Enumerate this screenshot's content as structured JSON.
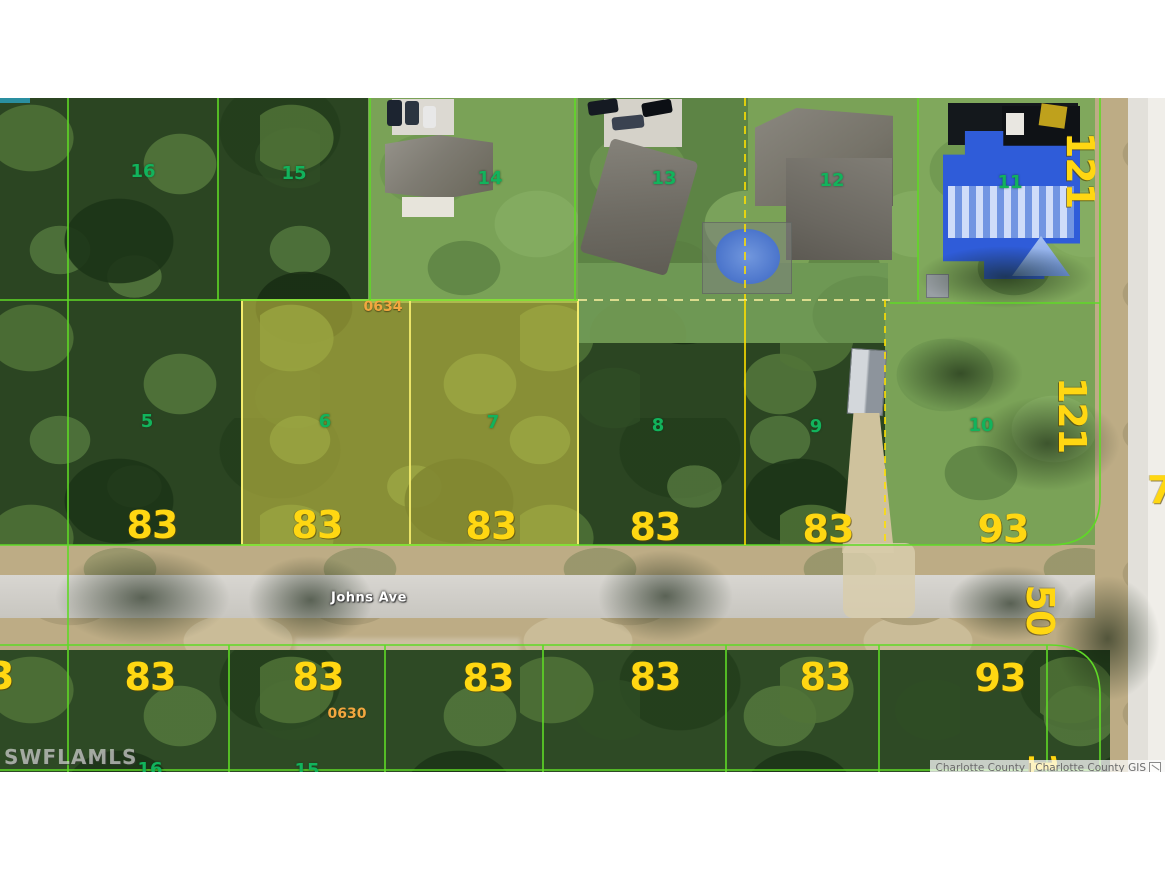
{
  "page": {
    "background": "#ffffff"
  },
  "map": {
    "street": {
      "label": "Johns Ave",
      "x": 369,
      "y": 598
    },
    "watermark": "SWFLAMLS",
    "attribution": "Charlotte County | Charlotte County GIS",
    "colors": {
      "boundary_green": "#5fd926",
      "boundary_yellow": "#ffe000",
      "highlight_fill": "rgba(213,204,71,0.55)",
      "parcel_number_green": "#12b35c",
      "dimension_yellow": "#ffd712",
      "block_number_orange": "#f2a73f",
      "road_gray": "#d2d0ca"
    },
    "parcel_numbers": [
      {
        "t": "16",
        "x": 143,
        "y": 172
      },
      {
        "t": "15",
        "x": 294,
        "y": 174
      },
      {
        "t": "14",
        "x": 490,
        "y": 179
      },
      {
        "t": "13",
        "x": 664,
        "y": 179
      },
      {
        "t": "12",
        "x": 832,
        "y": 181
      },
      {
        "t": "11",
        "x": 1010,
        "y": 183
      },
      {
        "t": "5",
        "x": 147,
        "y": 422
      },
      {
        "t": "6",
        "x": 325,
        "y": 422
      },
      {
        "t": "7",
        "x": 493,
        "y": 423
      },
      {
        "t": "8",
        "x": 658,
        "y": 426
      },
      {
        "t": "9",
        "x": 816,
        "y": 427
      },
      {
        "t": "10",
        "x": 981,
        "y": 426
      },
      {
        "t": "16",
        "x": 150,
        "y": 770
      },
      {
        "t": "15",
        "x": 307,
        "y": 771
      }
    ],
    "dimension_labels": [
      {
        "t": "83",
        "x": 152,
        "y": 525
      },
      {
        "t": "83",
        "x": 317,
        "y": 525
      },
      {
        "t": "83",
        "x": 491,
        "y": 526
      },
      {
        "t": "83",
        "x": 655,
        "y": 527
      },
      {
        "t": "83",
        "x": 828,
        "y": 529
      },
      {
        "t": "93",
        "x": 1003,
        "y": 529
      },
      {
        "t": "83",
        "x": 150,
        "y": 677
      },
      {
        "t": "83",
        "x": 318,
        "y": 677
      },
      {
        "t": "83",
        "x": 488,
        "y": 678
      },
      {
        "t": "83",
        "x": 655,
        "y": 677
      },
      {
        "t": "83",
        "x": 825,
        "y": 677
      },
      {
        "t": "93",
        "x": 1000,
        "y": 678
      },
      {
        "t": "121",
        "x": 1080,
        "y": 170,
        "r": 90
      },
      {
        "t": "121",
        "x": 1072,
        "y": 415,
        "r": 90
      },
      {
        "t": "50",
        "x": 1040,
        "y": 610,
        "r": 90
      },
      {
        "t": "7",
        "x": 1160,
        "y": 490
      },
      {
        "t": "83",
        "x": -12,
        "y": 676
      },
      {
        "t": "121",
        "x": 1042,
        "y": 790,
        "r": 90
      }
    ],
    "block_numbers": [
      {
        "t": "0634",
        "x": 383,
        "y": 307
      },
      {
        "t": "0630",
        "x": 347,
        "y": 714
      }
    ],
    "highlight": {
      "x": 242,
      "y": 300,
      "w": 336,
      "h": 245,
      "divider_x": 410
    },
    "boundaries": [
      {
        "d": "M68 98 V772",
        "c": "g"
      },
      {
        "d": "M218 98 V300",
        "c": "g"
      },
      {
        "d": "M370 98 V300",
        "c": "g"
      },
      {
        "d": "M575 98 V300",
        "c": "g"
      },
      {
        "d": "M745 98 V300",
        "c": "y",
        "dash": "8 6"
      },
      {
        "d": "M918 98 V300",
        "c": "g"
      },
      {
        "d": "M1100 98 V497 Q1100 545 1050 545 L0 545",
        "c": "g"
      },
      {
        "d": "M0 300 H578",
        "c": "g"
      },
      {
        "d": "M890 303 H1100",
        "c": "g"
      },
      {
        "d": "M578 300 H890",
        "c": "y2",
        "dash": "9 7"
      },
      {
        "d": "M745 300 V545",
        "c": "y"
      },
      {
        "d": "M885 300 V545",
        "c": "y",
        "dash": "7 6"
      },
      {
        "d": "M0 645 H1050 Q1100 645 1100 695 V772",
        "c": "g"
      },
      {
        "d": "M229 645 V772",
        "c": "g"
      },
      {
        "d": "M385 645 V772",
        "c": "g"
      },
      {
        "d": "M543 645 V772",
        "c": "g"
      },
      {
        "d": "M726 645 V772",
        "c": "g"
      },
      {
        "d": "M879 645 V772",
        "c": "g"
      },
      {
        "d": "M1047 645 V772",
        "c": "g"
      },
      {
        "d": "M0 770 H1100",
        "c": "g"
      }
    ]
  }
}
